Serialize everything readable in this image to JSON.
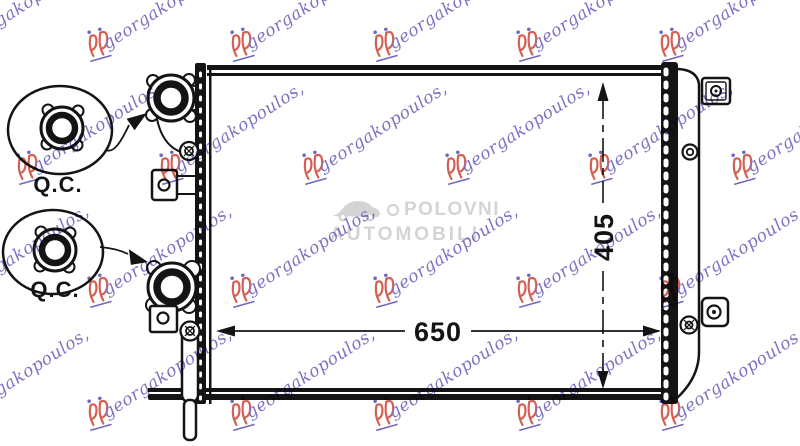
{
  "drawing": {
    "dim_width_label": "650",
    "dim_height_label": "405",
    "qc_top_label": "Q.C.",
    "qc_bottom_label": "Q.C.",
    "line_color": "#141414"
  },
  "watermark": {
    "brand_text": "georgakopoulos,",
    "text_color": "#5a52b5",
    "logo_color": "#c8392b",
    "dot_color": "#4a44aa",
    "center_line1": "POLOVNI",
    "center_line2": "AUTOMOBILI",
    "center_color": "#d2d2d2"
  }
}
